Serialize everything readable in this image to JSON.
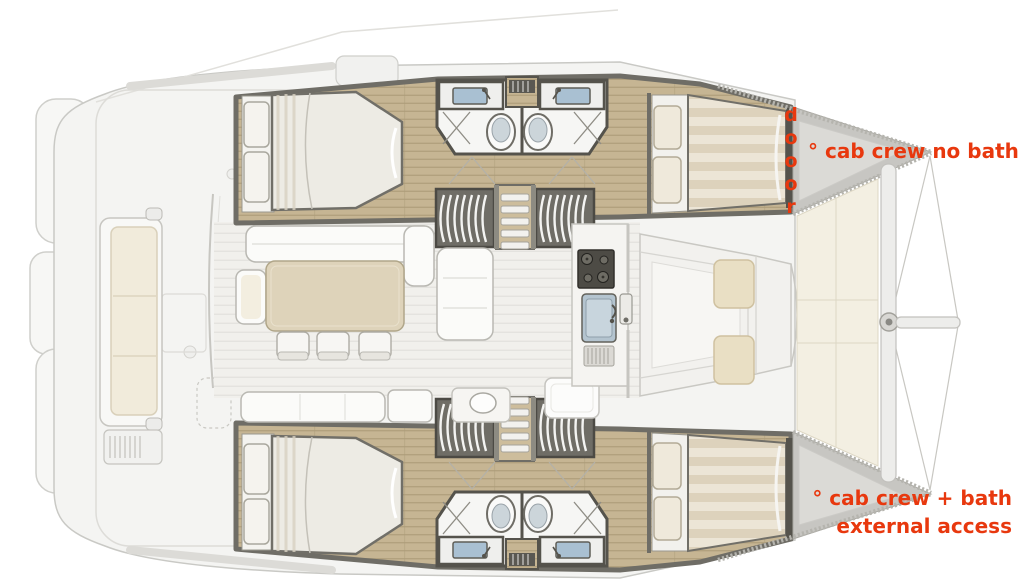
{
  "annotations": {
    "door": {
      "text": "dooor",
      "color": "#e8380e"
    },
    "top_crew_cabin": {
      "text": "° cab crew no bath",
      "color": "#e8380e"
    },
    "bottom_crew_cabin": {
      "line1": "° cab crew + bath",
      "line2": "external access",
      "color": "#e8380e"
    }
  },
  "palette": {
    "annotation_red": "#e8380e",
    "wood_floor": "#c6b593",
    "wall_dark": "#6f6d66",
    "deck_light": "#f4f4f2",
    "cushion_beige": "#e9dfc4",
    "sink_blue": "#a9c0d2",
    "trampoline_ivory": "#f3efe2"
  }
}
